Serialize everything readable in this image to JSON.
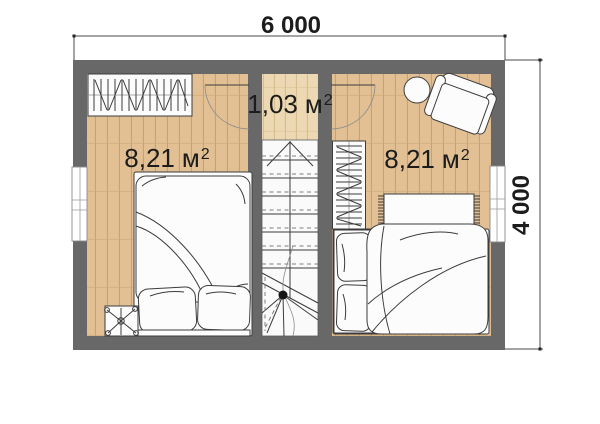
{
  "plan": {
    "dimensions": {
      "width_label": "6 000",
      "height_label": "4 000"
    },
    "rooms": [
      {
        "name": "bedroom-left",
        "area_value": "8,21",
        "area_unit": "м",
        "area_sup": "2"
      },
      {
        "name": "hallway",
        "area_value": "1,03",
        "area_unit": "м",
        "area_sup": "2"
      },
      {
        "name": "bedroom-right",
        "area_value": "8,21",
        "area_unit": "м",
        "area_sup": "2"
      }
    ],
    "colors": {
      "wall": "#686868",
      "floor-room": "#e2c094",
      "floor-room-line": "#c9a271",
      "floor-hall": "#ecd8b2",
      "floor-hall-line": "#d6bd8f",
      "stairs-bg": "#fafafa",
      "furniture-fill": "#fcfcfc",
      "line": "#3c3c3c",
      "dim": "#4a4a4a",
      "text": "#1c1c1c"
    },
    "symbols": [
      "wardrobe-left",
      "door-left",
      "door-right",
      "staircase",
      "stair-direction-arrow",
      "wardrobe-right",
      "side-table",
      "armchair",
      "rug",
      "bed-left",
      "bed-right",
      "plant",
      "window-left",
      "window-right"
    ]
  }
}
